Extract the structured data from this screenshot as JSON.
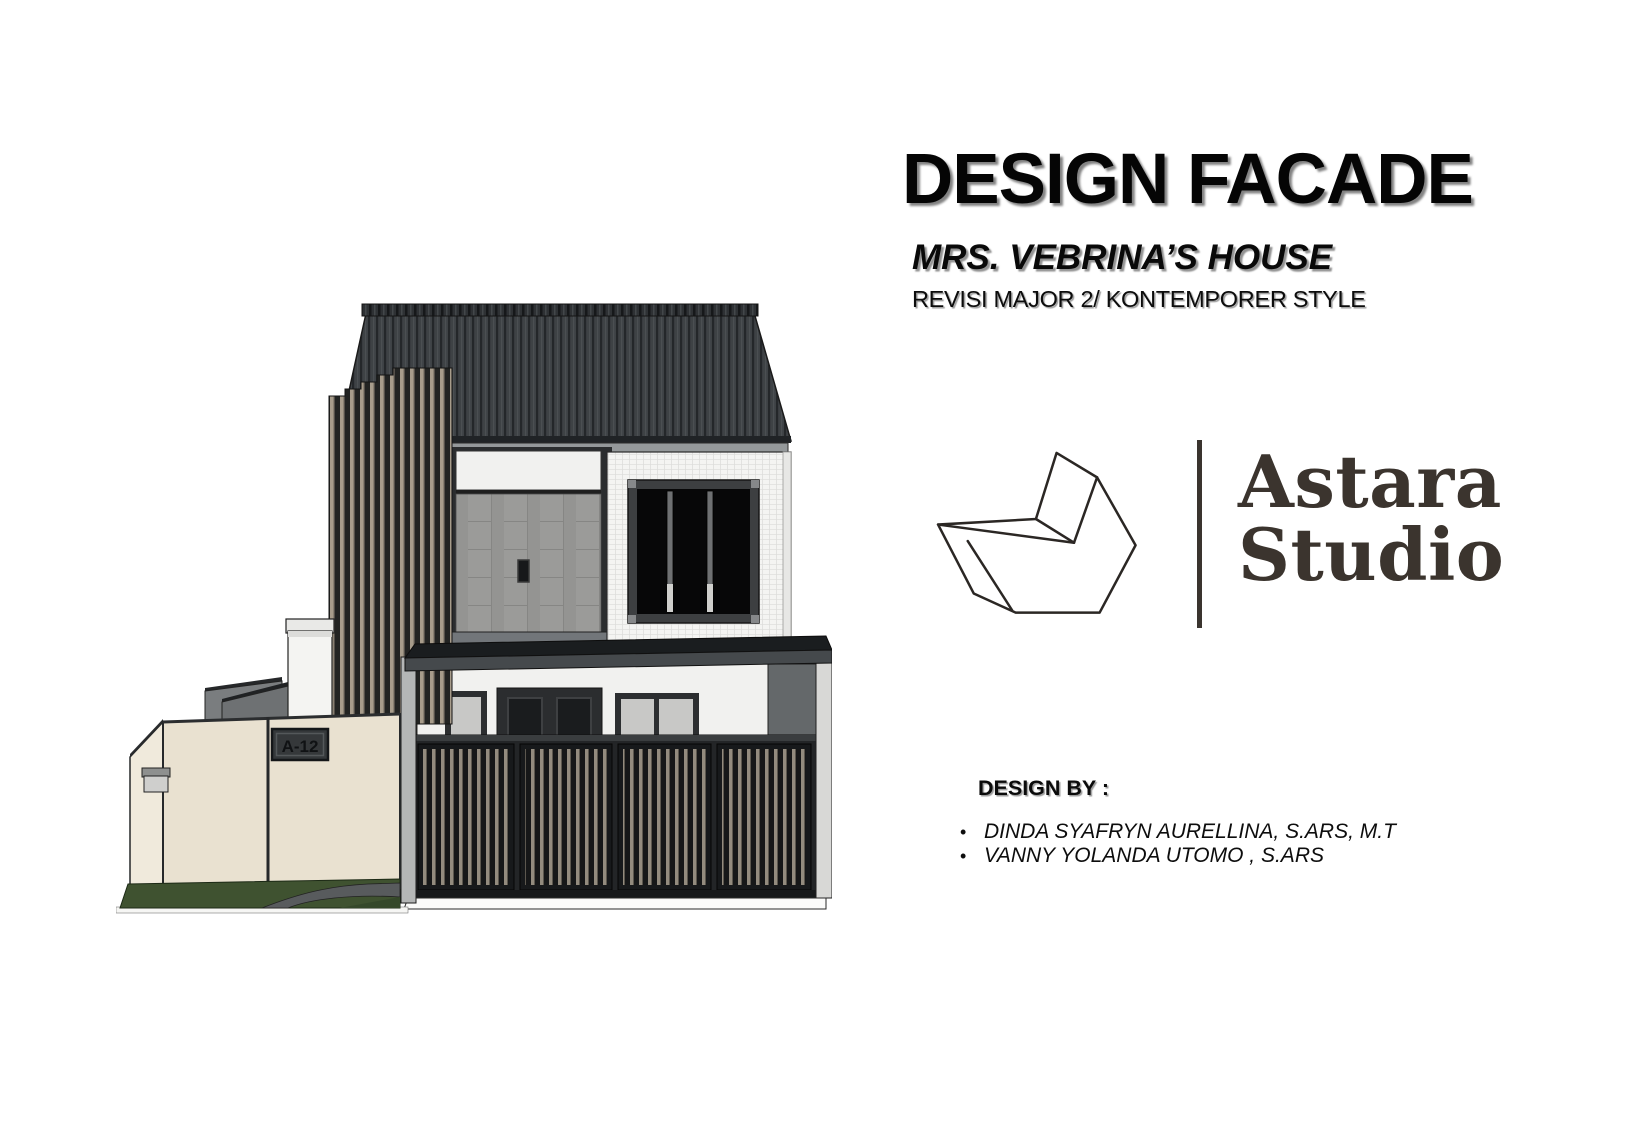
{
  "page": {
    "background": "#ffffff"
  },
  "header": {
    "title": "DESIGN FACADE",
    "subtitle": "MRS. VEBRINA’S HOUSE",
    "revision_note": "REVISI MAJOR 2/ KONTEMPORER STYLE"
  },
  "logo": {
    "studio_name_line1": "Astara",
    "studio_name_line2": "Studio",
    "mark": "origami-paper-fold-mark",
    "text_color": "#3b342e"
  },
  "credits": {
    "heading": "DESIGN BY :",
    "bullet": "•",
    "designers": [
      "DINDA SYAFRYN AURELLINA, S.ARS, M.T",
      "VANNY YOLANDA UTOMO , S.ARS"
    ]
  },
  "illustration": {
    "description": "Two-storey contemporary house facade render: dark standing-seam gable roof, timber slat screen, slatted front gate, beige boundary wall and grass strip",
    "house_number": "A-12",
    "colors": {
      "roof": "#3e4245",
      "slat_light": "#a79c8b",
      "slat_dark": "#222322",
      "white_wall": "#f4f4f2",
      "gray_tile": "#9b9b99",
      "canopy": "#1a1d1f",
      "beige_wall": "#e9e1d0",
      "grass": "#3f5230"
    }
  }
}
